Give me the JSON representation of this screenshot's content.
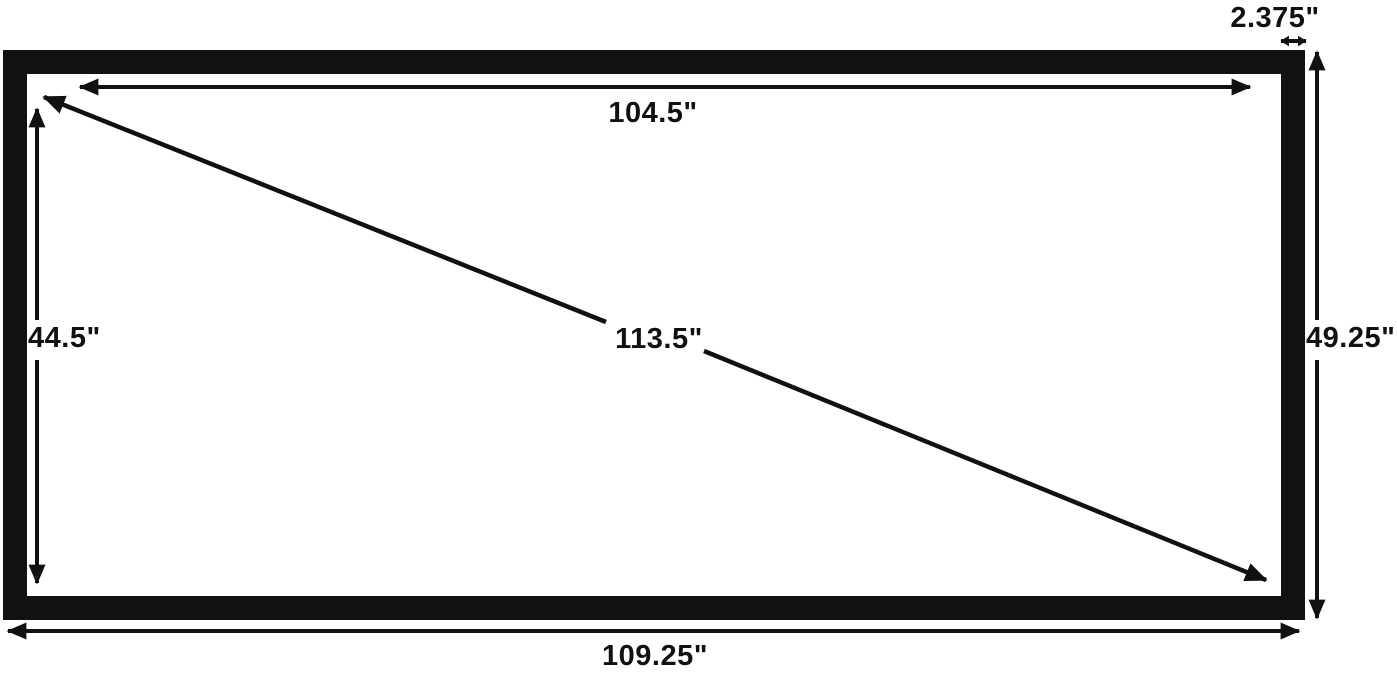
{
  "diagram": {
    "labels": {
      "inner_width": "104.5\"",
      "inner_height": "44.5\"",
      "diagonal": "113.5\"",
      "outer_width": "109.25\"",
      "outer_height": "49.25\"",
      "frame_thickness": "2.375\""
    },
    "colors": {
      "frame": "#111111",
      "arrows": "#111111",
      "text": "#111111",
      "background": "#ffffff"
    }
  }
}
